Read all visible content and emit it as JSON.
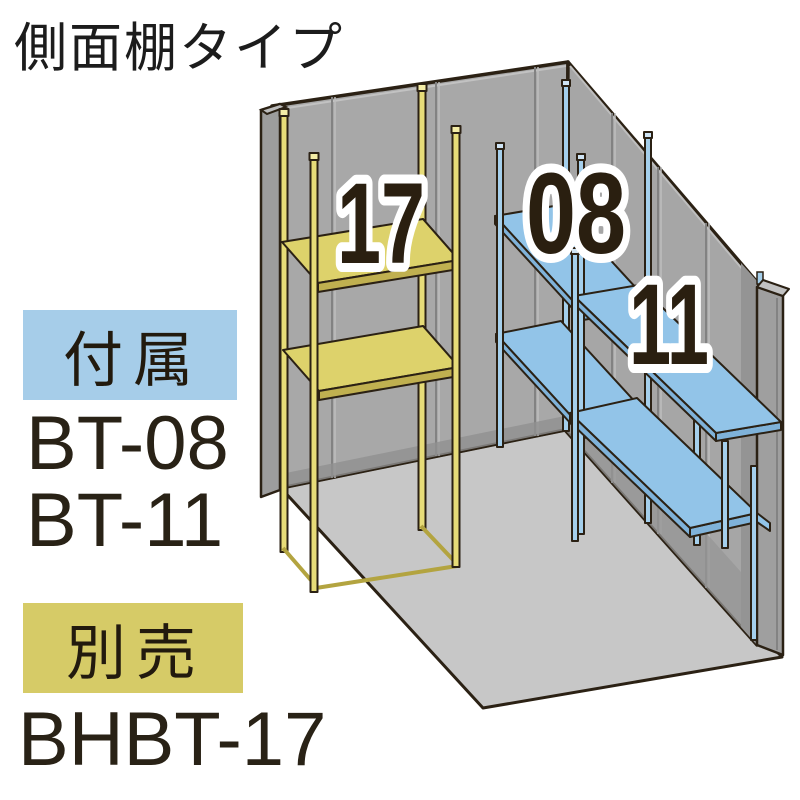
{
  "title": "側面棚タイプ",
  "legend": {
    "included": {
      "badge": "付属",
      "badge_color": "#a6cde9",
      "items": [
        "BT-08",
        "BT-11"
      ]
    },
    "sold_separately": {
      "badge": "別売",
      "badge_color": "#d6cb67",
      "items": [
        "BHBT-17"
      ]
    }
  },
  "illustration": {
    "shelf_labels": {
      "yellow_unit": "17",
      "blue_unit_short": "08",
      "blue_unit_long": "11"
    },
    "colors": {
      "included_shelf_blue": "#92c4e8",
      "separate_shelf_yellow": "#ddd26b",
      "wall_gray": "#a6a6a6",
      "floor_gray": "#c7c7c7",
      "outline": "#2b2114"
    }
  }
}
